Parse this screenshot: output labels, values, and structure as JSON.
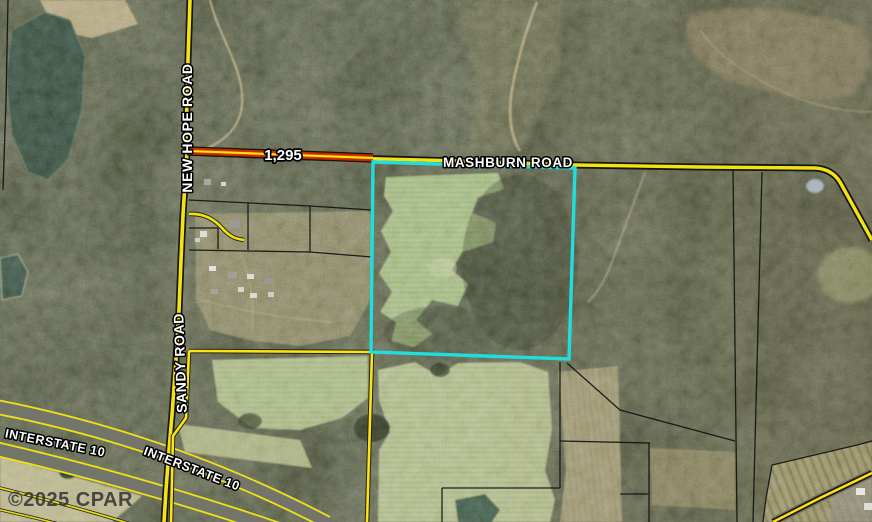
{
  "map": {
    "labels": {
      "new_hope_road": "NEW HOPE ROAD",
      "sandy_road": "SANDY ROAD",
      "mashburn_road": "MASHBURN ROAD",
      "interstate_10_west": "INTERSTATE 10",
      "interstate_10_east": "INTERSTATE 10",
      "frontage_distance": "1,295"
    },
    "watermark": "©2025 CPAR",
    "colors": {
      "road_yellow": "#f2e114",
      "boundary_yellow": "#ffe30f",
      "highlight_red": "#c22800",
      "highlight_red_bright": "#e04a00",
      "parcel_cyan": "#1fdede",
      "parcel_line_black": "#101010",
      "forest_base": "#454a35",
      "field_green": "#a7b37d",
      "pond_dark": "#35493c"
    }
  }
}
